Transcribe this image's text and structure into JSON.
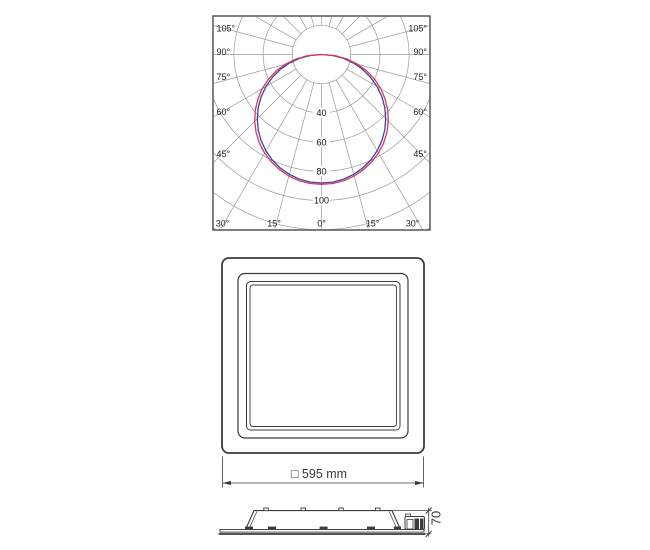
{
  "colors": {
    "background": "#ffffff",
    "line": "#3c3c3c",
    "grid": "#9a9a9a",
    "frame": "#4a4a4a",
    "text": "#222222",
    "curve_blue": "#4040a8",
    "curve_red": "#d5395f"
  },
  "polar_chart": {
    "angle_labels_left": [
      "105°",
      "90°",
      "75°",
      "60°",
      "45°"
    ],
    "angle_labels_right": [
      "105°",
      "90°",
      "75°",
      "60°",
      "45°"
    ],
    "angle_labels_bottom": [
      "30°",
      "15°",
      "0°",
      "15°",
      "30°"
    ],
    "radial_tick_labels": [
      "40",
      "60",
      "80",
      "100"
    ]
  },
  "chart_data": {
    "type": "line",
    "subtype": "photometric-polar-intensity-distribution",
    "angle_ticks_deg": [
      0,
      15,
      30,
      45,
      60,
      75,
      90,
      105
    ],
    "radial_ticks": [
      40,
      60,
      80,
      100
    ],
    "radial_circles": [
      20,
      40,
      60,
      80,
      100,
      120,
      140
    ],
    "angles_deg": [
      0,
      5,
      10,
      15,
      20,
      25,
      30,
      35,
      40,
      45,
      50,
      55,
      60,
      65,
      70,
      75,
      80,
      85,
      90
    ],
    "series": [
      {
        "name": "blue-curve",
        "color": "#4040a8",
        "values": [
          88,
          87.7,
          86.7,
          85,
          82.7,
          79.8,
          76.2,
          72.1,
          67.4,
          62.2,
          56.6,
          50.5,
          44,
          37.2,
          30.1,
          22.8,
          15.3,
          7.7,
          0
        ]
      },
      {
        "name": "red-curve",
        "color": "#d5395f",
        "values": [
          89,
          88.7,
          87.8,
          86.2,
          84,
          81.2,
          78,
          74.1,
          69.7,
          64.7,
          59.2,
          53.2,
          47,
          40.2,
          33,
          25.6,
          17.6,
          9.4,
          0
        ]
      }
    ]
  },
  "front_view": {
    "dimension_label": "□ 595 mm"
  },
  "side_view": {
    "dimension_label": "70"
  }
}
